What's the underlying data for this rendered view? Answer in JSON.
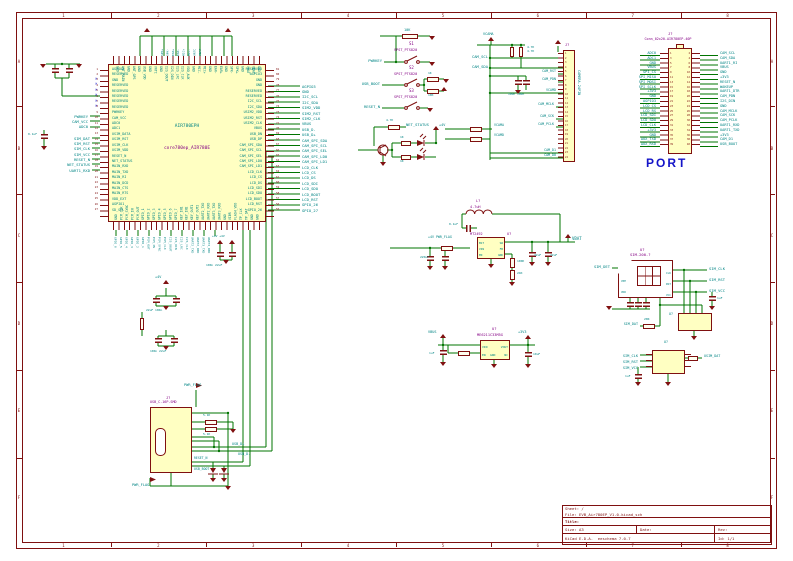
{
  "sheet": {
    "cols": [
      "1",
      "2",
      "3",
      "4",
      "5",
      "6",
      "7",
      "8"
    ],
    "rows": [
      "A",
      "B",
      "C",
      "D",
      "E",
      "F"
    ]
  },
  "title_block": {
    "sheet": "Sheet: /",
    "file": "File: EVB_Air780EP_V1.0.kicad_sch",
    "title": "Title:",
    "size": "Size: A3",
    "date": "Date:",
    "rev": "Rev:",
    "tool": "KiCad E.D.A.  eeschema 7.0.7",
    "id": "Id: 1/1"
  },
  "refs": {
    "u": "U?",
    "r": "R?",
    "c": "C?",
    "j": "J?",
    "d": "D?",
    "q": "Q?",
    "l": "L?"
  },
  "chip": {
    "name": "AIR780EPH",
    "value": "core780ep_AIR780E",
    "pins_left": [
      "AGPIO2",
      "RESERVED",
      "GND",
      "RESERVED",
      "RESERVED",
      "RESERVED",
      "RESERVED",
      "RESERVED",
      "PWRKEY",
      "CAM_VCC",
      "ADC0",
      "ADC1",
      "USIM_DATA",
      "USIM_RST",
      "USIM_CLK",
      "USIM_VDD",
      "RESET_N",
      "NET_STATUS",
      "MAIN_RXD",
      "MAIN_TXD",
      "MAIN_RI",
      "MAIN_DCD",
      "MAIN_CTS",
      "MAIN_RTS",
      "VDD_EXT",
      "AGPIO1",
      "SD_SEL"
    ],
    "pins_right": [
      "RESERVED",
      "AGPIO3",
      "GND",
      "GND",
      "RESERVED",
      "RESERVED",
      "I2C_SCL",
      "I2C_SDA",
      "USIM2_VDD",
      "USIM2_RST",
      "USIM2_CLK",
      "VBUS",
      "USB_DN",
      "USB_DP",
      "CAM_SPI_SDA",
      "CAM_SPI_SCL",
      "CAM_SPI_SEL",
      "CAM_SPI_LD0",
      "CAM_SPI_LD1",
      "LCD_CLK",
      "LCD_CS",
      "LCD_DS",
      "LCD_SDI",
      "LCD_SDO",
      "LCD_BOOT",
      "LCD_RST",
      "GPIO_26"
    ],
    "pins_top": [
      "GND",
      "VBAT",
      "VBAT",
      "GND",
      "SPK+",
      "SPK-",
      "GND",
      "EAR+",
      "EAR-",
      "GND",
      "MIC+",
      "MIC-",
      "GND",
      "VDD_AUX",
      "I2S_CLK",
      "I2S_LRC",
      "I2S_DIN",
      "I2S_DOUT",
      "GND",
      "VRTC",
      "GND",
      "USB_VDD",
      "GND",
      "ANT_GPS",
      "GND",
      "ANT_MAIN",
      "GND"
    ],
    "pins_bottom": [
      "GND",
      "PCM_CLK",
      "PCM_SYNC",
      "PCM_IN",
      "PCM_OUT",
      "GPIO_1",
      "GPIO_2",
      "GPIO_3",
      "GPIO_4",
      "GPIO_5",
      "GPIO_6",
      "GPIO_7",
      "KEY_IN1",
      "KEY_IN2",
      "KEY_OUT1",
      "KEY_OUT2",
      "UART2_TXD",
      "UART2_RXD",
      "UART3_TXD",
      "UART3_RXD",
      "GND",
      "VIBR",
      "FLASH_VDD",
      "TP_CLK",
      "TP_DAT",
      "GND",
      "GND"
    ],
    "nc_marks": "×\n×\n×\n×\n×\n×"
  },
  "left_area": {
    "stack1": [
      "PWRKEY",
      "CAM_VCC",
      "ADC0"
    ],
    "stack2": [
      "SIM_DAT",
      "SIM_RST",
      "SIM_CLK",
      "SIM_VCC",
      "RESET_N",
      "NET_STATUS",
      "UART1_RXD"
    ],
    "c3_val": "0.1uF"
  },
  "right_area": {
    "stack": [
      "AGPIO3",
      "GND",
      "I2C_SCL",
      "I2C_SDA",
      "SIM2_VDD",
      "SIM2_RST",
      "SIM2_CLK",
      "VBUS",
      "USB_D-",
      "USB_D+",
      "CAM_SPI_SDA",
      "CAM_SPI_SCL",
      "CAM_SPI_SEL",
      "CAM_SPI_LD0",
      "CAM_SPI_LD1",
      "LCD_CLK",
      "LCD_CS",
      "LCD_DS",
      "LCD_SDI",
      "LCD_SDO",
      "LCD_BOOT",
      "LCD_RST",
      "GPIO_26",
      "GPIO_27"
    ]
  },
  "top_area": {
    "nets": [
      "SPK+",
      "SPK-",
      "EAR+",
      "EAR-",
      "MIC+",
      "MIC-",
      "VRTC",
      "VBAT"
    ]
  },
  "bottom_area": {
    "nets": [
      "UART3_RXD",
      "UART3_TXD",
      "UART2_RXD",
      "UART2_TXD",
      "I2S_CLK",
      "I2S_LRC",
      "I2S_DIN",
      "I2S_DOUT",
      "PCM_CLK",
      "PCM_SYNC",
      "PCM_IN",
      "PCM_OUT",
      "GPIO_1",
      "GPIO_2",
      "GPIO_3",
      "GPIO_4",
      "GPIO_5",
      "GPIO_6"
    ],
    "plus4a": "+4V",
    "plus4b": "+4V +4V",
    "cap_vals1": "22uF 100n",
    "cap_vals2": "100n 22uF",
    "cap_vals3": "100n 22uF"
  },
  "buttons": {
    "s1": "S1",
    "s2": "S2",
    "s3": "S3",
    "part": "SPST_PTS820",
    "net1": "PWRKEY",
    "net2": "USB_BOOT",
    "net3": "RESET_N",
    "r_top_val": "10K",
    "r_a": "1K",
    "r_b": "10K"
  },
  "netlight": {
    "net": "NET_STATUS",
    "r_base": "4.7K",
    "r1": "1K",
    "r2": "1K",
    "pwr": "+4V"
  },
  "camera": {
    "ref": "J?",
    "value": "CAMERA-24PIN",
    "vcama": "VCAMA",
    "pullups": "4.7K\n4.7K",
    "scl": "CAM_SCL",
    "sda": "CAM_SDA",
    "mid": [
      "CAM_RST",
      "CAM_PDN",
      "VCAMD",
      "CAM_MCLK",
      "CAM_SCK",
      "CAM_PCLK",
      "CAM_D1",
      "CAM_D0"
    ],
    "caps": "100n 100n",
    "feed1": "VCAMA",
    "feed2": "VCAMD"
  },
  "port": {
    "ref": "J?",
    "part": "Conn_02x20-AIR780EP-40P",
    "title": "PORT",
    "left": [
      "ADC0",
      "ADC1",
      "GND",
      "VBUS",
      "SPI_CS",
      "SPI_MISO",
      "SPI_MOSI",
      "SPI_SCLK",
      "+3V3",
      "GND",
      "AGPIO3",
      "LCD_CS",
      "LCD_RS",
      "LCD_SDI",
      "LCD_SDO",
      "LCD_CLK",
      "+3V3",
      "GND",
      "AUX_TXD",
      "AUX_RXD"
    ],
    "right": [
      "CAM_SCL",
      "CAM_SDA",
      "UART1_RI",
      "VBUS",
      "GND",
      "+3V3",
      "RESET_N",
      "WAKEUP",
      "UART1_DTR",
      "CAM_PDN",
      "I2S_DIN",
      "GND",
      "CAM_MCLK",
      "CAM_SCK",
      "CAM_PCLK",
      "UART1_RXD",
      "UART1_TXD",
      "+3V3",
      "CAM_D1",
      "USB_BOOT"
    ]
  },
  "dcdc": {
    "l_ref": "L?",
    "l_val": "4.7uH",
    "c_bst": "0.1uF",
    "ref": "U?",
    "value": "MT2492",
    "pl": "BST\nVIN\nEN",
    "pr": "SW\nFB\nGND",
    "in_lbl": "+4V PWR_FLAG",
    "cin": "220uF",
    "fb1": "100K",
    "fb2": "24K",
    "cout": "22uF",
    "cout2": "22uF",
    "out": "VBAT"
  },
  "sim": {
    "ref": "U?",
    "value": "SIM-200-?",
    "det": "SIM_DET",
    "clk": "SIM_CLK",
    "rst": "SIM_RST",
    "vcc": "SIM_VCC",
    "dat": "SIM_DAT",
    "r_dat": "20R",
    "c_out": "1uF",
    "esd_ref": "U?",
    "inside_l": "VPP\nVDD",
    "inside_r": "CLK\nRST\nVCC"
  },
  "simesd": {
    "ref": "U?",
    "left": [
      "SIM_CLK",
      "SIM_RST",
      "SIM_VCC"
    ],
    "right": "USIM_DAT",
    "c": "1uF"
  },
  "ldo": {
    "ref": "U?",
    "value": "ME6211C33M5G",
    "pl": "VIN\nEN",
    "pr": "VOUT\nNC",
    "gnd": "GND",
    "in": "VBUS",
    "out": "+3V3",
    "cin": "1uF",
    "cout": "10uF"
  },
  "usb": {
    "ref": "J?",
    "part": "USB_C-16P-SMD",
    "flag": "PWR_FLAG",
    "cc1": "5.1K",
    "cc2": "5.1K",
    "dp": "USB_D+",
    "dn": "USB_D-",
    "reset": "RESET_N",
    "boot": "USB_BOOT"
  },
  "power": {
    "gnd": "GND",
    "vbat": "VBAT",
    "vbus": "VBUS",
    "v3": "+3V3",
    "v4": "+4V",
    "vcama": "VCAMA"
  }
}
